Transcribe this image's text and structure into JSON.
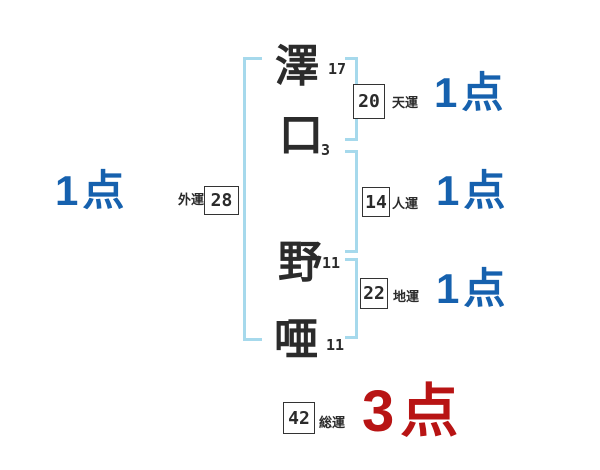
{
  "characters": [
    {
      "glyph": "澤",
      "strokes": "17"
    },
    {
      "glyph": "口",
      "strokes": "3"
    },
    {
      "glyph": "野",
      "strokes": "11"
    },
    {
      "glyph": "唖",
      "strokes": "11"
    }
  ],
  "fortunes": [
    {
      "id": "heaven",
      "label": "天運",
      "value": "20",
      "score": "1点"
    },
    {
      "id": "person",
      "label": "人運",
      "value": "14",
      "score": "1点"
    },
    {
      "id": "earth",
      "label": "地運",
      "value": "22",
      "score": "1点"
    },
    {
      "id": "outer",
      "label": "外運",
      "value": "28",
      "score": "1点"
    },
    {
      "id": "total",
      "label": "総運",
      "value": "42",
      "score": "3点"
    }
  ],
  "colors": {
    "bracket": "#a6d9ec",
    "score_blue": "#1661ae",
    "score_red": "#b81414",
    "ink": "#2b2b2b"
  }
}
